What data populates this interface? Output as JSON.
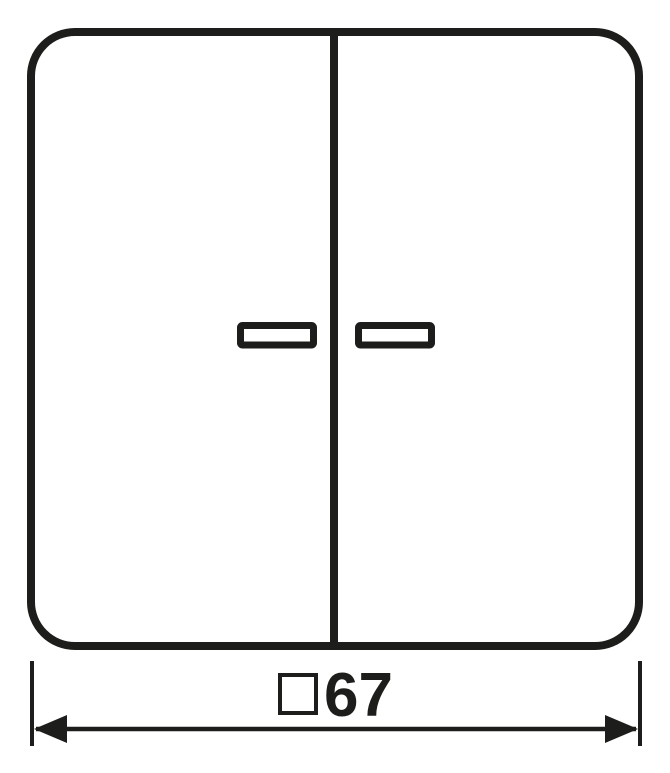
{
  "colors": {
    "stroke": "#1d1d1b",
    "background": "#ffffff"
  },
  "drawing": {
    "subject": "two-gang rocker switch cover, front view",
    "parts": {
      "frame": "rounded-square cover outline",
      "divider": "center split between left and right rockers",
      "left_window": "left indicator lens window",
      "right_window": "right indicator lens window"
    }
  },
  "dimension": {
    "label": "□67",
    "symbol": "□",
    "symbol_name": "square-symbol",
    "value": "67"
  }
}
